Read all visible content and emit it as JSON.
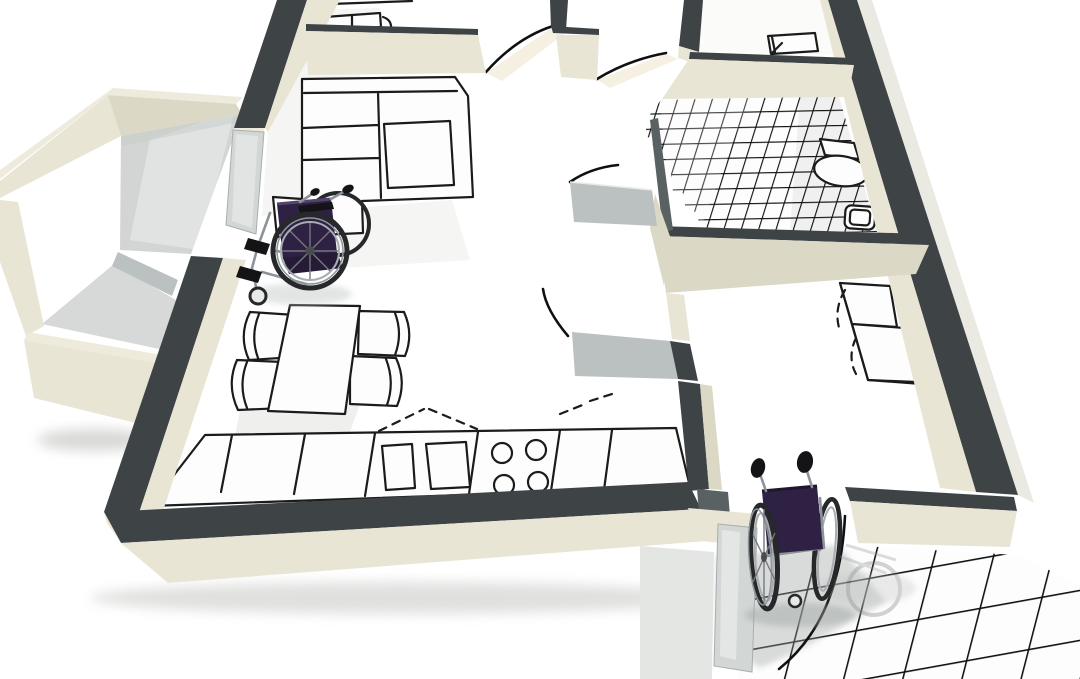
{
  "meta": {
    "description": "3D cutaway architectural rendering of a wheelchair-accessible apartment floor plan, viewed from above at an angle, with two wheelchairs",
    "canvas": {
      "width": 1080,
      "height": 679
    }
  },
  "colors": {
    "canvas_bg": "#ffffff",
    "wall_top": "#3e4446",
    "wall_top_soft": "#5a6163",
    "cream": "#e8e5d5",
    "cream_bright": "#eeebdc",
    "cream_shade": "#dcd8c6",
    "cream_deep": "#cfcbb6",
    "gray_face": "#bbc0c1",
    "gray_light": "#d6d9d7",
    "balcony_floor": "#d2d5d3",
    "paper": "#fdfdfd",
    "line": "#1b1b1b",
    "tile_line": "#121212",
    "arc": "#101010",
    "spill": "#ece4cb",
    "leaf": "#d2d6d5",
    "shadow_soft": "#d8d9d7",
    "shadow_tile": "#9fa5a2",
    "wc_seat": "#2e2143",
    "wc_seat_dark": "#251b37",
    "wc_frame": "#8d9499",
    "wc_tire": "#26282a",
    "wc_rim": "#a7adb1",
    "wc_grip": "#141417"
  },
  "scene": {
    "rooms": [
      {
        "name": "balcony",
        "floor": "gray"
      },
      {
        "name": "living-room",
        "floor": "white"
      },
      {
        "name": "dining-area",
        "floor": "white"
      },
      {
        "name": "kitchen",
        "floor": "white"
      },
      {
        "name": "bathroom",
        "floor": "tiled"
      },
      {
        "name": "bedroom",
        "floor": "white"
      },
      {
        "name": "hallway",
        "floor": "white"
      },
      {
        "name": "entry-porch",
        "floor": "tiled"
      }
    ],
    "furniture": [
      "sectional-sofa",
      "coffee-table",
      "dining-table",
      "dining-chairs-x4",
      "kitchen-counter",
      "double-sink",
      "stove-4-burners",
      "bathroom-sink",
      "toilet",
      "wardrobe-with-dashed-doors",
      "bench-top-room",
      "table-top-right-room"
    ],
    "wheelchairs": [
      {
        "location": "living-room",
        "seat_color": "dark-purple"
      },
      {
        "location": "entry-door",
        "seat_color": "dark-purple"
      }
    ],
    "door_swing_arcs": 6,
    "tiled_floors": [
      "bathroom",
      "entry-porch"
    ]
  }
}
